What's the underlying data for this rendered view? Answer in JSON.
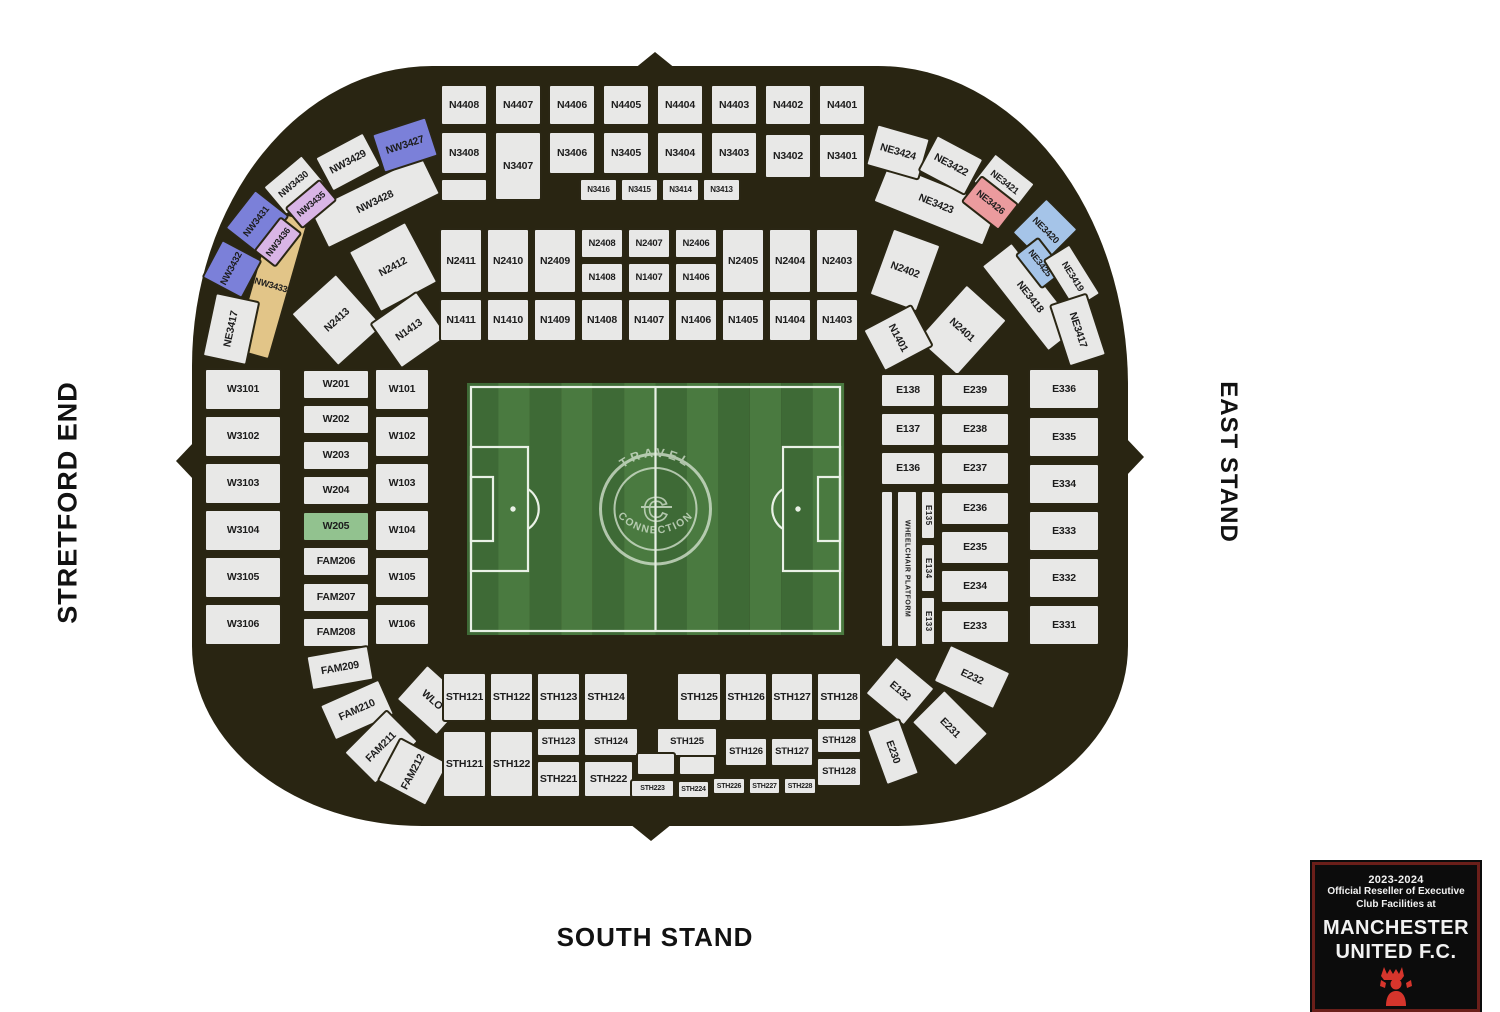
{
  "stands": {
    "west": "STRETFORD END",
    "east": "EAST STAND",
    "south": "SOUTH STAND"
  },
  "badge": {
    "season": "2023-2024",
    "line1": "Official Reseller of Executive",
    "line2": "Club Facilities at",
    "club_line1": "MANCHESTER",
    "club_line2": "UNITED F.C."
  },
  "pitch": {
    "watermark_top": "TRAVEL",
    "watermark_bottom": "CONNECTION",
    "watermark_center": "C"
  },
  "colors": {
    "bowl": "#292512",
    "cell": "#e8e8e7",
    "cell_border": "#2a2614",
    "pw": "#7b80d9",
    "li": "#d9b5e6",
    "gd": "#e2c588",
    "pk": "#eb9b9e",
    "bl": "#a5c4e8",
    "gr": "#92c28f",
    "pitch_dark": "#3e6a36",
    "pitch_light": "#4a7a40",
    "pitch_line": "#e9f1e6",
    "badge_border": "#6b1f1a",
    "devil_red": "#d6352c"
  },
  "sections": [
    {
      "t": "N4408",
      "x": 440,
      "y": 84,
      "w": 48,
      "h": 42
    },
    {
      "t": "N4407",
      "x": 494,
      "y": 84,
      "w": 48,
      "h": 42
    },
    {
      "t": "N4406",
      "x": 548,
      "y": 84,
      "w": 48,
      "h": 42
    },
    {
      "t": "N4405",
      "x": 602,
      "y": 84,
      "w": 48,
      "h": 42
    },
    {
      "t": "N4404",
      "x": 656,
      "y": 84,
      "w": 48,
      "h": 42
    },
    {
      "t": "N4403",
      "x": 710,
      "y": 84,
      "w": 48,
      "h": 42
    },
    {
      "t": "N4402",
      "x": 764,
      "y": 84,
      "w": 48,
      "h": 42
    },
    {
      "t": "N4401",
      "x": 818,
      "y": 84,
      "w": 48,
      "h": 42
    },
    {
      "t": "N3408",
      "x": 440,
      "y": 131,
      "w": 48,
      "h": 44
    },
    {
      "t": "N3407",
      "x": 494,
      "y": 131,
      "w": 48,
      "h": 70
    },
    {
      "t": "N3406",
      "x": 548,
      "y": 131,
      "w": 48,
      "h": 44
    },
    {
      "t": "N3405",
      "x": 602,
      "y": 131,
      "w": 48,
      "h": 44
    },
    {
      "t": "N3404",
      "x": 656,
      "y": 131,
      "w": 48,
      "h": 44
    },
    {
      "t": "N3403",
      "x": 710,
      "y": 131,
      "w": 48,
      "h": 44
    },
    {
      "t": "N3402",
      "x": 764,
      "y": 133,
      "w": 48,
      "h": 46
    },
    {
      "t": "N3401",
      "x": 818,
      "y": 133,
      "w": 48,
      "h": 46
    },
    {
      "t": "",
      "x": 440,
      "y": 178,
      "w": 48,
      "h": 24
    },
    {
      "t": "N3416",
      "x": 579,
      "y": 178,
      "w": 39,
      "h": 24,
      "f": 8
    },
    {
      "t": "N3415",
      "x": 620,
      "y": 178,
      "w": 39,
      "h": 24,
      "f": 8
    },
    {
      "t": "N3414",
      "x": 661,
      "y": 178,
      "w": 39,
      "h": 24,
      "f": 8
    },
    {
      "t": "N3413",
      "x": 702,
      "y": 178,
      "w": 39,
      "h": 24,
      "f": 8
    },
    {
      "t": "NW3428",
      "x": 312,
      "y": 180,
      "w": 126,
      "h": 44,
      "r": -26
    },
    {
      "t": "NW3433",
      "x": 252,
      "y": 212,
      "w": 38,
      "h": 146,
      "r": 16,
      "c": "gd",
      "f": 9
    },
    {
      "t": "NW3427",
      "x": 376,
      "y": 124,
      "w": 58,
      "h": 42,
      "r": -18,
      "c": "pw"
    },
    {
      "t": "NW3429",
      "x": 320,
      "y": 142,
      "w": 56,
      "h": 40,
      "r": -28
    },
    {
      "t": "NW3430",
      "x": 268,
      "y": 166,
      "w": 52,
      "h": 38,
      "r": -40,
      "f": 9.5
    },
    {
      "t": "NW3435",
      "x": 288,
      "y": 190,
      "w": 46,
      "h": 28,
      "r": -40,
      "c": "li",
      "f": 9
    },
    {
      "t": "NW3431",
      "x": 232,
      "y": 200,
      "w": 50,
      "h": 44,
      "r": -52,
      "c": "pw",
      "f": 9.5
    },
    {
      "t": "NW3436",
      "x": 256,
      "y": 228,
      "w": 44,
      "h": 28,
      "r": -52,
      "c": "li",
      "f": 9
    },
    {
      "t": "NW3432",
      "x": 210,
      "y": 246,
      "w": 44,
      "h": 46,
      "r": -62,
      "c": "pw",
      "f": 9.5
    },
    {
      "t": "NE3417",
      "x": 198,
      "y": 306,
      "w": 66,
      "h": 46,
      "r": -78
    },
    {
      "t": "N2413",
      "x": 306,
      "y": 284,
      "w": 62,
      "h": 72,
      "r": -42
    },
    {
      "t": "N2412",
      "x": 360,
      "y": 232,
      "w": 66,
      "h": 70,
      "r": -28
    },
    {
      "t": "N1413",
      "x": 380,
      "y": 302,
      "w": 58,
      "h": 56,
      "r": -35
    },
    {
      "t": "N2411",
      "x": 439,
      "y": 228,
      "w": 44,
      "h": 66
    },
    {
      "t": "N2410",
      "x": 486,
      "y": 228,
      "w": 44,
      "h": 66
    },
    {
      "t": "N2409",
      "x": 533,
      "y": 228,
      "w": 44,
      "h": 66
    },
    {
      "t": "N2408",
      "x": 580,
      "y": 228,
      "w": 44,
      "h": 31,
      "f": 9.5
    },
    {
      "t": "N2407",
      "x": 627,
      "y": 228,
      "w": 44,
      "h": 31,
      "f": 9.5
    },
    {
      "t": "N2406",
      "x": 674,
      "y": 228,
      "w": 44,
      "h": 31,
      "f": 9.5
    },
    {
      "t": "N1408",
      "x": 580,
      "y": 262,
      "w": 44,
      "h": 32,
      "f": 9.5
    },
    {
      "t": "N1407",
      "x": 627,
      "y": 262,
      "w": 44,
      "h": 32,
      "f": 9.5
    },
    {
      "t": "N1406",
      "x": 674,
      "y": 262,
      "w": 44,
      "h": 32,
      "f": 9.5
    },
    {
      "t": "N2405",
      "x": 721,
      "y": 228,
      "w": 44,
      "h": 66
    },
    {
      "t": "N2404",
      "x": 768,
      "y": 228,
      "w": 44,
      "h": 66
    },
    {
      "t": "N2403",
      "x": 815,
      "y": 228,
      "w": 44,
      "h": 66
    },
    {
      "t": "N1411",
      "x": 439,
      "y": 298,
      "w": 44,
      "h": 44
    },
    {
      "t": "N1410",
      "x": 486,
      "y": 298,
      "w": 44,
      "h": 44
    },
    {
      "t": "N1409",
      "x": 533,
      "y": 298,
      "w": 44,
      "h": 44
    },
    {
      "t": "N1408",
      "x": 580,
      "y": 298,
      "w": 44,
      "h": 44
    },
    {
      "t": "N1407",
      "x": 627,
      "y": 298,
      "w": 44,
      "h": 44
    },
    {
      "t": "N1406",
      "x": 674,
      "y": 298,
      "w": 44,
      "h": 44
    },
    {
      "t": "N1405",
      "x": 721,
      "y": 298,
      "w": 44,
      "h": 44
    },
    {
      "t": "N1404",
      "x": 768,
      "y": 298,
      "w": 44,
      "h": 44
    },
    {
      "t": "N1403",
      "x": 815,
      "y": 298,
      "w": 44,
      "h": 44
    },
    {
      "t": "NE3423",
      "x": 876,
      "y": 182,
      "w": 120,
      "h": 44,
      "r": 22
    },
    {
      "t": "NE3418",
      "x": 975,
      "y": 277,
      "w": 110,
      "h": 40,
      "r": 52
    },
    {
      "t": "NE3424",
      "x": 870,
      "y": 130,
      "w": 56,
      "h": 44,
      "r": 16
    },
    {
      "t": "NE3422",
      "x": 924,
      "y": 144,
      "w": 54,
      "h": 42,
      "r": 28
    },
    {
      "t": "NE3421",
      "x": 978,
      "y": 164,
      "w": 52,
      "h": 38,
      "r": 38,
      "f": 9.5
    },
    {
      "t": "NE3426",
      "x": 966,
      "y": 186,
      "w": 48,
      "h": 34,
      "r": 38,
      "c": "pk",
      "f": 9.5
    },
    {
      "t": "NE3420",
      "x": 1022,
      "y": 206,
      "w": 46,
      "h": 50,
      "r": 45,
      "c": "bl",
      "f": 9.5
    },
    {
      "t": "NE3425",
      "x": 1018,
      "y": 248,
      "w": 44,
      "h": 30,
      "r": 52,
      "c": "bl",
      "f": 9
    },
    {
      "t": "NE3419",
      "x": 1042,
      "y": 261,
      "w": 60,
      "h": 32,
      "r": 58,
      "f": 9.5
    },
    {
      "t": "NE3417",
      "x": 1045,
      "y": 310,
      "w": 66,
      "h": 40,
      "r": 72
    },
    {
      "t": "N2402",
      "x": 879,
      "y": 234,
      "w": 52,
      "h": 72,
      "r": 20
    },
    {
      "t": "N2401",
      "x": 934,
      "y": 292,
      "w": 56,
      "h": 76,
      "r": 42
    },
    {
      "t": "N1401",
      "x": 874,
      "y": 310,
      "w": 48,
      "h": 56,
      "r": 62
    },
    {
      "t": "W3101",
      "x": 204,
      "y": 368,
      "w": 78,
      "h": 43
    },
    {
      "t": "W3102",
      "x": 204,
      "y": 415,
      "w": 78,
      "h": 43
    },
    {
      "t": "W3103",
      "x": 204,
      "y": 462,
      "w": 78,
      "h": 43
    },
    {
      "t": "W3104",
      "x": 204,
      "y": 509,
      "w": 78,
      "h": 43
    },
    {
      "t": "W3105",
      "x": 204,
      "y": 556,
      "w": 78,
      "h": 43
    },
    {
      "t": "W3106",
      "x": 204,
      "y": 603,
      "w": 78,
      "h": 43
    },
    {
      "t": "W201",
      "x": 302,
      "y": 369,
      "w": 68,
      "h": 31
    },
    {
      "t": "W202",
      "x": 302,
      "y": 404,
      "w": 68,
      "h": 31
    },
    {
      "t": "W203",
      "x": 302,
      "y": 440,
      "w": 68,
      "h": 31
    },
    {
      "t": "W204",
      "x": 302,
      "y": 475,
      "w": 68,
      "h": 31
    },
    {
      "t": "W205",
      "x": 302,
      "y": 511,
      "w": 68,
      "h": 31,
      "c": "gr"
    },
    {
      "t": "FAM206",
      "x": 302,
      "y": 546,
      "w": 68,
      "h": 31
    },
    {
      "t": "FAM207",
      "x": 302,
      "y": 582,
      "w": 68,
      "h": 31
    },
    {
      "t": "FAM208",
      "x": 302,
      "y": 617,
      "w": 68,
      "h": 31
    },
    {
      "t": "W101",
      "x": 374,
      "y": 368,
      "w": 56,
      "h": 43
    },
    {
      "t": "W102",
      "x": 374,
      "y": 415,
      "w": 56,
      "h": 43
    },
    {
      "t": "W103",
      "x": 374,
      "y": 462,
      "w": 56,
      "h": 43
    },
    {
      "t": "W104",
      "x": 374,
      "y": 509,
      "w": 56,
      "h": 43
    },
    {
      "t": "W105",
      "x": 374,
      "y": 556,
      "w": 56,
      "h": 43
    },
    {
      "t": "W106",
      "x": 374,
      "y": 603,
      "w": 56,
      "h": 43
    },
    {
      "t": "E138",
      "x": 880,
      "y": 373,
      "w": 56,
      "h": 35
    },
    {
      "t": "E137",
      "x": 880,
      "y": 412,
      "w": 56,
      "h": 35
    },
    {
      "t": "E136",
      "x": 880,
      "y": 451,
      "w": 56,
      "h": 35
    },
    {
      "t": "",
      "x": 880,
      "y": 490,
      "w": 14,
      "h": 158
    },
    {
      "t": "WHEELCHAIR PLATFORM",
      "x": 896,
      "y": 490,
      "w": 22,
      "h": 158,
      "v": 1,
      "f": 7
    },
    {
      "t": "E135",
      "x": 920,
      "y": 490,
      "w": 16,
      "h": 50,
      "v": 1,
      "f": 8
    },
    {
      "t": "E134",
      "x": 920,
      "y": 543,
      "w": 16,
      "h": 50,
      "v": 1,
      "f": 8
    },
    {
      "t": "E133",
      "x": 920,
      "y": 596,
      "w": 16,
      "h": 50,
      "v": 1,
      "f": 8
    },
    {
      "t": "E239",
      "x": 940,
      "y": 373,
      "w": 70,
      "h": 35
    },
    {
      "t": "E238",
      "x": 940,
      "y": 412,
      "w": 70,
      "h": 35
    },
    {
      "t": "E237",
      "x": 940,
      "y": 451,
      "w": 70,
      "h": 35
    },
    {
      "t": "E236",
      "x": 940,
      "y": 491,
      "w": 70,
      "h": 35
    },
    {
      "t": "E235",
      "x": 940,
      "y": 530,
      "w": 70,
      "h": 35
    },
    {
      "t": "E234",
      "x": 940,
      "y": 569,
      "w": 70,
      "h": 35
    },
    {
      "t": "E233",
      "x": 940,
      "y": 609,
      "w": 70,
      "h": 35
    },
    {
      "t": "E336",
      "x": 1028,
      "y": 368,
      "w": 72,
      "h": 42
    },
    {
      "t": "E335",
      "x": 1028,
      "y": 416,
      "w": 72,
      "h": 42
    },
    {
      "t": "E334",
      "x": 1028,
      "y": 463,
      "w": 72,
      "h": 42
    },
    {
      "t": "E333",
      "x": 1028,
      "y": 510,
      "w": 72,
      "h": 42
    },
    {
      "t": "E332",
      "x": 1028,
      "y": 557,
      "w": 72,
      "h": 42
    },
    {
      "t": "E331",
      "x": 1028,
      "y": 604,
      "w": 72,
      "h": 42
    },
    {
      "t": "FAM209",
      "x": 308,
      "y": 650,
      "w": 64,
      "h": 36,
      "r": -10
    },
    {
      "t": "FAM210",
      "x": 324,
      "y": 690,
      "w": 66,
      "h": 40,
      "r": -24
    },
    {
      "t": "FAM211",
      "x": 350,
      "y": 724,
      "w": 62,
      "h": 46,
      "r": -45
    },
    {
      "t": "FAM212",
      "x": 388,
      "y": 744,
      "w": 50,
      "h": 56,
      "r": -62
    },
    {
      "t": "WLO",
      "x": 404,
      "y": 676,
      "w": 56,
      "h": 48,
      "r": 42
    },
    {
      "t": "STH121",
      "x": 442,
      "y": 672,
      "w": 45,
      "h": 50
    },
    {
      "t": "STH122",
      "x": 489,
      "y": 672,
      "w": 45,
      "h": 50
    },
    {
      "t": "STH123",
      "x": 536,
      "y": 672,
      "w": 45,
      "h": 50
    },
    {
      "t": "STH124",
      "x": 583,
      "y": 672,
      "w": 46,
      "h": 50
    },
    {
      "t": "STH125",
      "x": 676,
      "y": 672,
      "w": 46,
      "h": 50
    },
    {
      "t": "STH126",
      "x": 724,
      "y": 672,
      "w": 44,
      "h": 50
    },
    {
      "t": "STH127",
      "x": 770,
      "y": 672,
      "w": 44,
      "h": 50
    },
    {
      "t": "STH128",
      "x": 816,
      "y": 672,
      "w": 46,
      "h": 50
    },
    {
      "t": "STH121",
      "x": 442,
      "y": 730,
      "w": 45,
      "h": 68
    },
    {
      "t": "STH122",
      "x": 489,
      "y": 730,
      "w": 45,
      "h": 68
    },
    {
      "t": "STH123",
      "x": 536,
      "y": 727,
      "w": 45,
      "h": 30,
      "f": 9.5
    },
    {
      "t": "STH124",
      "x": 583,
      "y": 727,
      "w": 56,
      "h": 30,
      "f": 9.5
    },
    {
      "t": "STH125",
      "x": 656,
      "y": 727,
      "w": 62,
      "h": 30,
      "f": 9.5
    },
    {
      "t": "STH126",
      "x": 724,
      "y": 737,
      "w": 44,
      "h": 30,
      "f": 9.5
    },
    {
      "t": "STH127",
      "x": 770,
      "y": 737,
      "w": 44,
      "h": 30,
      "f": 9.5
    },
    {
      "t": "STH128",
      "x": 816,
      "y": 727,
      "w": 46,
      "h": 27,
      "f": 9.5
    },
    {
      "t": "STH221",
      "x": 536,
      "y": 760,
      "w": 45,
      "h": 38
    },
    {
      "t": "STH222",
      "x": 583,
      "y": 760,
      "w": 51,
      "h": 38
    },
    {
      "t": "",
      "x": 636,
      "y": 752,
      "w": 40,
      "h": 24
    },
    {
      "t": "",
      "x": 678,
      "y": 755,
      "w": 38,
      "h": 21
    },
    {
      "t": "STH128",
      "x": 816,
      "y": 757,
      "w": 46,
      "h": 30,
      "f": 9.5
    },
    {
      "t": "STH223",
      "x": 630,
      "y": 779,
      "w": 45,
      "h": 19,
      "f": 7
    },
    {
      "t": "STH224",
      "x": 677,
      "y": 780,
      "w": 33,
      "h": 19,
      "f": 7
    },
    {
      "t": "STH226",
      "x": 712,
      "y": 777,
      "w": 34,
      "h": 18,
      "f": 7
    },
    {
      "t": "STH227",
      "x": 748,
      "y": 777,
      "w": 33,
      "h": 18,
      "f": 7
    },
    {
      "t": "STH228",
      "x": 783,
      "y": 777,
      "w": 34,
      "h": 18,
      "f": 7
    },
    {
      "t": "E132",
      "x": 874,
      "y": 666,
      "w": 52,
      "h": 50,
      "r": 40
    },
    {
      "t": "E232",
      "x": 938,
      "y": 656,
      "w": 68,
      "h": 42,
      "r": 25
    },
    {
      "t": "E231",
      "x": 918,
      "y": 704,
      "w": 64,
      "h": 48,
      "r": 45
    },
    {
      "t": "E230",
      "x": 863,
      "y": 734,
      "w": 60,
      "h": 36,
      "r": 70
    }
  ]
}
